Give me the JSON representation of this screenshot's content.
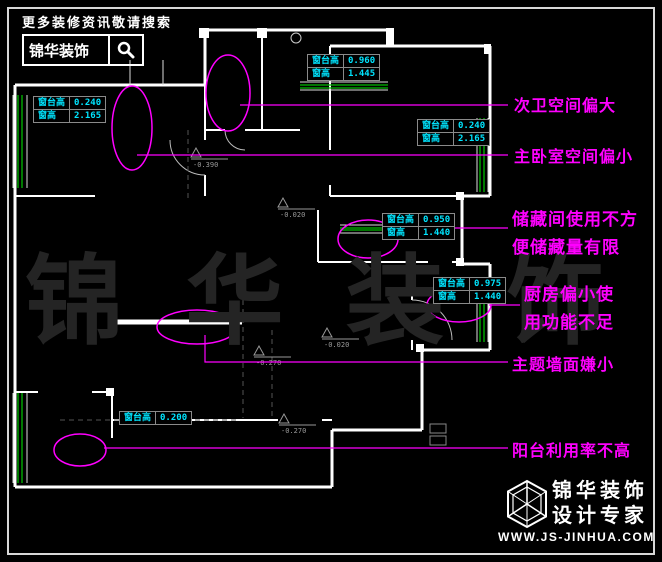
{
  "colors": {
    "background": "#000000",
    "plan_lines": "#ffffff",
    "window_glass_green": "#00bb00",
    "annotation_magenta": "#ff00ff",
    "dimension_cyan": "#00e5ff",
    "watermark_gray": "#242424"
  },
  "header": {
    "tagline": "更多装修资讯敬请搜索",
    "brand": "锦华装饰",
    "search_icon": "magnifier"
  },
  "annotations": [
    {
      "id": "secondary-bath",
      "lines": [
        "次卫空间偏大"
      ]
    },
    {
      "id": "master-bedroom",
      "lines": [
        "主卧室空间偏小"
      ]
    },
    {
      "id": "storage-room",
      "lines": [
        "储藏间使用不方",
        "便储藏量有限"
      ]
    },
    {
      "id": "kitchen",
      "lines": [
        "厨房偏小使",
        "用功能不足"
      ]
    },
    {
      "id": "theme-wall",
      "lines": [
        "主题墙面嫌小"
      ]
    },
    {
      "id": "balcony",
      "lines": [
        "阳台利用率不高"
      ]
    }
  ],
  "window_tables": [
    {
      "location": "left-bedroom-window",
      "rows": [
        {
          "k": "窗台高",
          "v": "0.240"
        },
        {
          "k": "窗高",
          "v": "2.165"
        }
      ]
    },
    {
      "location": "top-bath-window",
      "rows": [
        {
          "k": "窗台高",
          "v": "0.960"
        },
        {
          "k": "窗高",
          "v": "1.445"
        }
      ]
    },
    {
      "location": "right-bedroom-window",
      "rows": [
        {
          "k": "窗台高",
          "v": "0.240"
        },
        {
          "k": "窗高",
          "v": "2.165"
        }
      ]
    },
    {
      "location": "storage-window",
      "rows": [
        {
          "k": "窗台高",
          "v": "0.950"
        },
        {
          "k": "窗高",
          "v": "1.440"
        }
      ]
    },
    {
      "location": "kitchen-window",
      "rows": [
        {
          "k": "窗台高",
          "v": "0.975"
        },
        {
          "k": "窗高",
          "v": "1.440"
        }
      ]
    },
    {
      "location": "balcony-window",
      "rows": [
        {
          "k": "窗台高",
          "v": "0.200"
        }
      ]
    }
  ],
  "level_markers": [
    {
      "value": "-0.390"
    },
    {
      "value": "-0.020"
    },
    {
      "value": "-0.020"
    },
    {
      "value": "-0.270"
    },
    {
      "value": "-0.270"
    }
  ],
  "watermark": {
    "text": "锦 华 装 饰"
  },
  "footer": {
    "logo": "cube-logo",
    "brand_line1": "锦华装饰",
    "brand_line2": "设计专家",
    "website": "WWW.JS-JINHUA.COM"
  }
}
